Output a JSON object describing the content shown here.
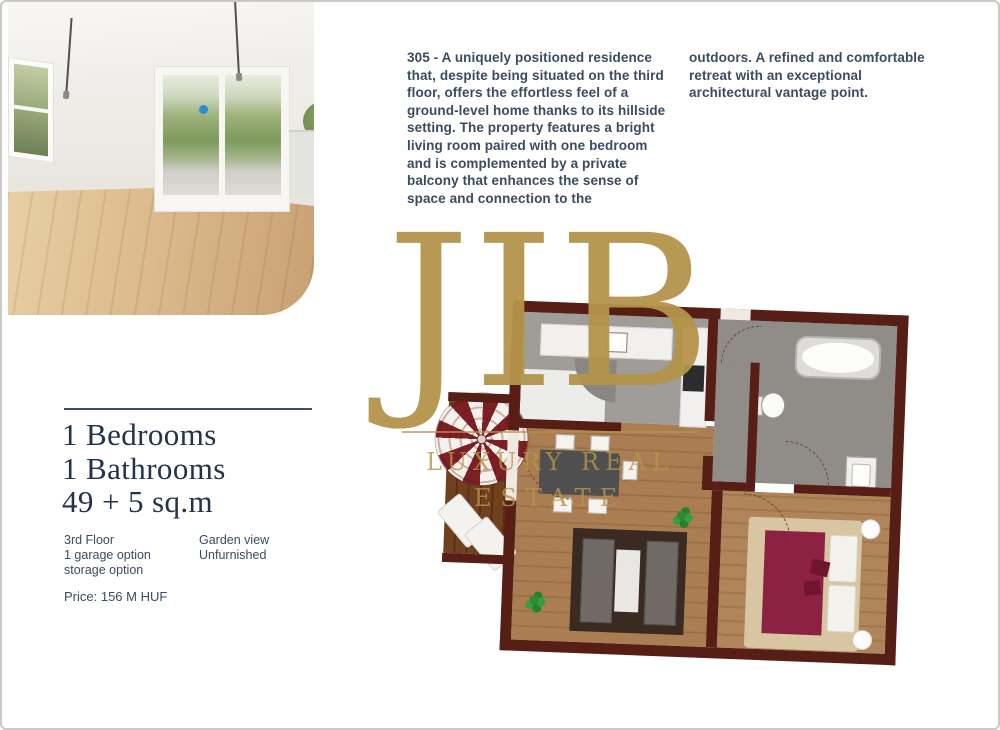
{
  "listing": {
    "description": {
      "col1": "305 - A uniquely positioned residence that, despite being situated on the third floor, offers the effortless feel of a ground-level home thanks to its hillside setting. The property features a bright living room paired with one bedroom and is complemented by a private balcony that enhances the sense of space and connection to the",
      "col2": "outdoors. A refined and comfortable retreat with an exceptional architectural vantage point."
    },
    "summary": {
      "bedrooms": "1 Bedrooms",
      "bathrooms": "1 Bathrooms",
      "area": "49 + 5 sq.m"
    },
    "features": {
      "floor": "3rd Floor",
      "garage": "1 garage option",
      "storage": "storage option",
      "view": "Garden view",
      "furnishing": "Unfurnished"
    },
    "price": "Price: 156 M HUF"
  },
  "logo": {
    "monogram": "JIB",
    "tagline_line1": "LUXURY REAL",
    "tagline_line2": "ESTATE",
    "gold_color": "#b5944a"
  },
  "floorplan": {
    "rooms": [
      "balcony",
      "living-room",
      "kitchen",
      "hallway",
      "bathroom",
      "bedroom"
    ],
    "icons": [
      "parasol-icon",
      "plant-icon",
      "bathtub-icon",
      "toilet-icon",
      "sink-icon",
      "bed",
      "sofa",
      "dining-table",
      "lounger",
      "door-swing-arc"
    ],
    "colors": {
      "wall": "#571e15",
      "living_wood": "#aa7e52",
      "bedroom_wood": "#b0855a",
      "balcony_wood": "#70401f",
      "gray_floor": "#908c88",
      "bed_blanket": "#8c2144",
      "bed_frame": "#d8c6a2"
    }
  }
}
